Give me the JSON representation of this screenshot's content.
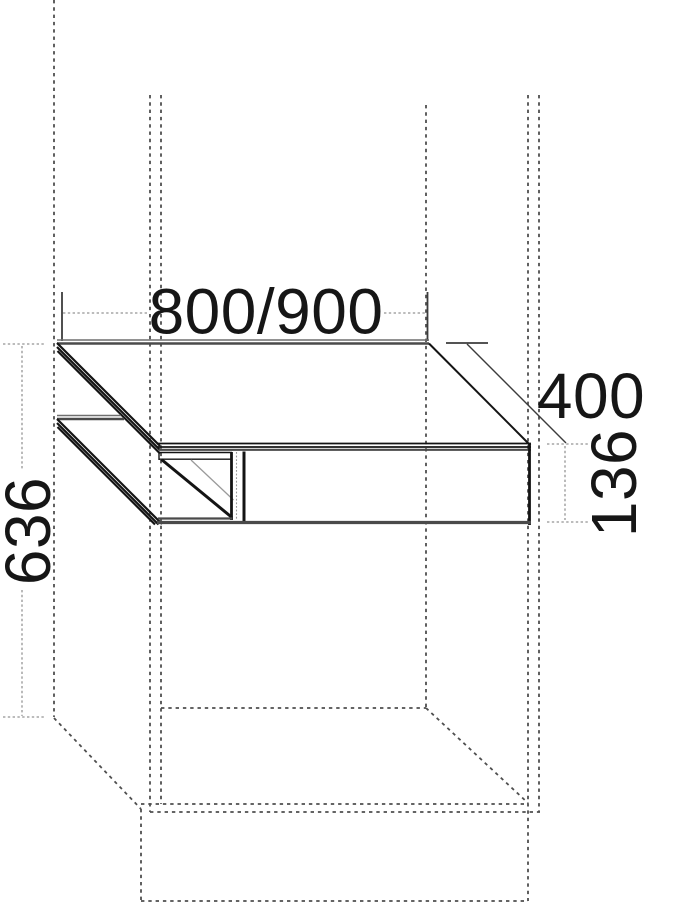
{
  "drawing": {
    "kind": "furniture-dimension-drawing",
    "dimension_labels": {
      "width": "800/900",
      "depth": "400",
      "front_height": "136",
      "install_height": "636"
    },
    "colors": {
      "background": "#ffffff",
      "solid_edge": "#141414",
      "shade_band": "#4a4a4a",
      "context_dashed": "#4f4f4f",
      "dimension_line": "#949494",
      "label_text": "#161616"
    }
  }
}
